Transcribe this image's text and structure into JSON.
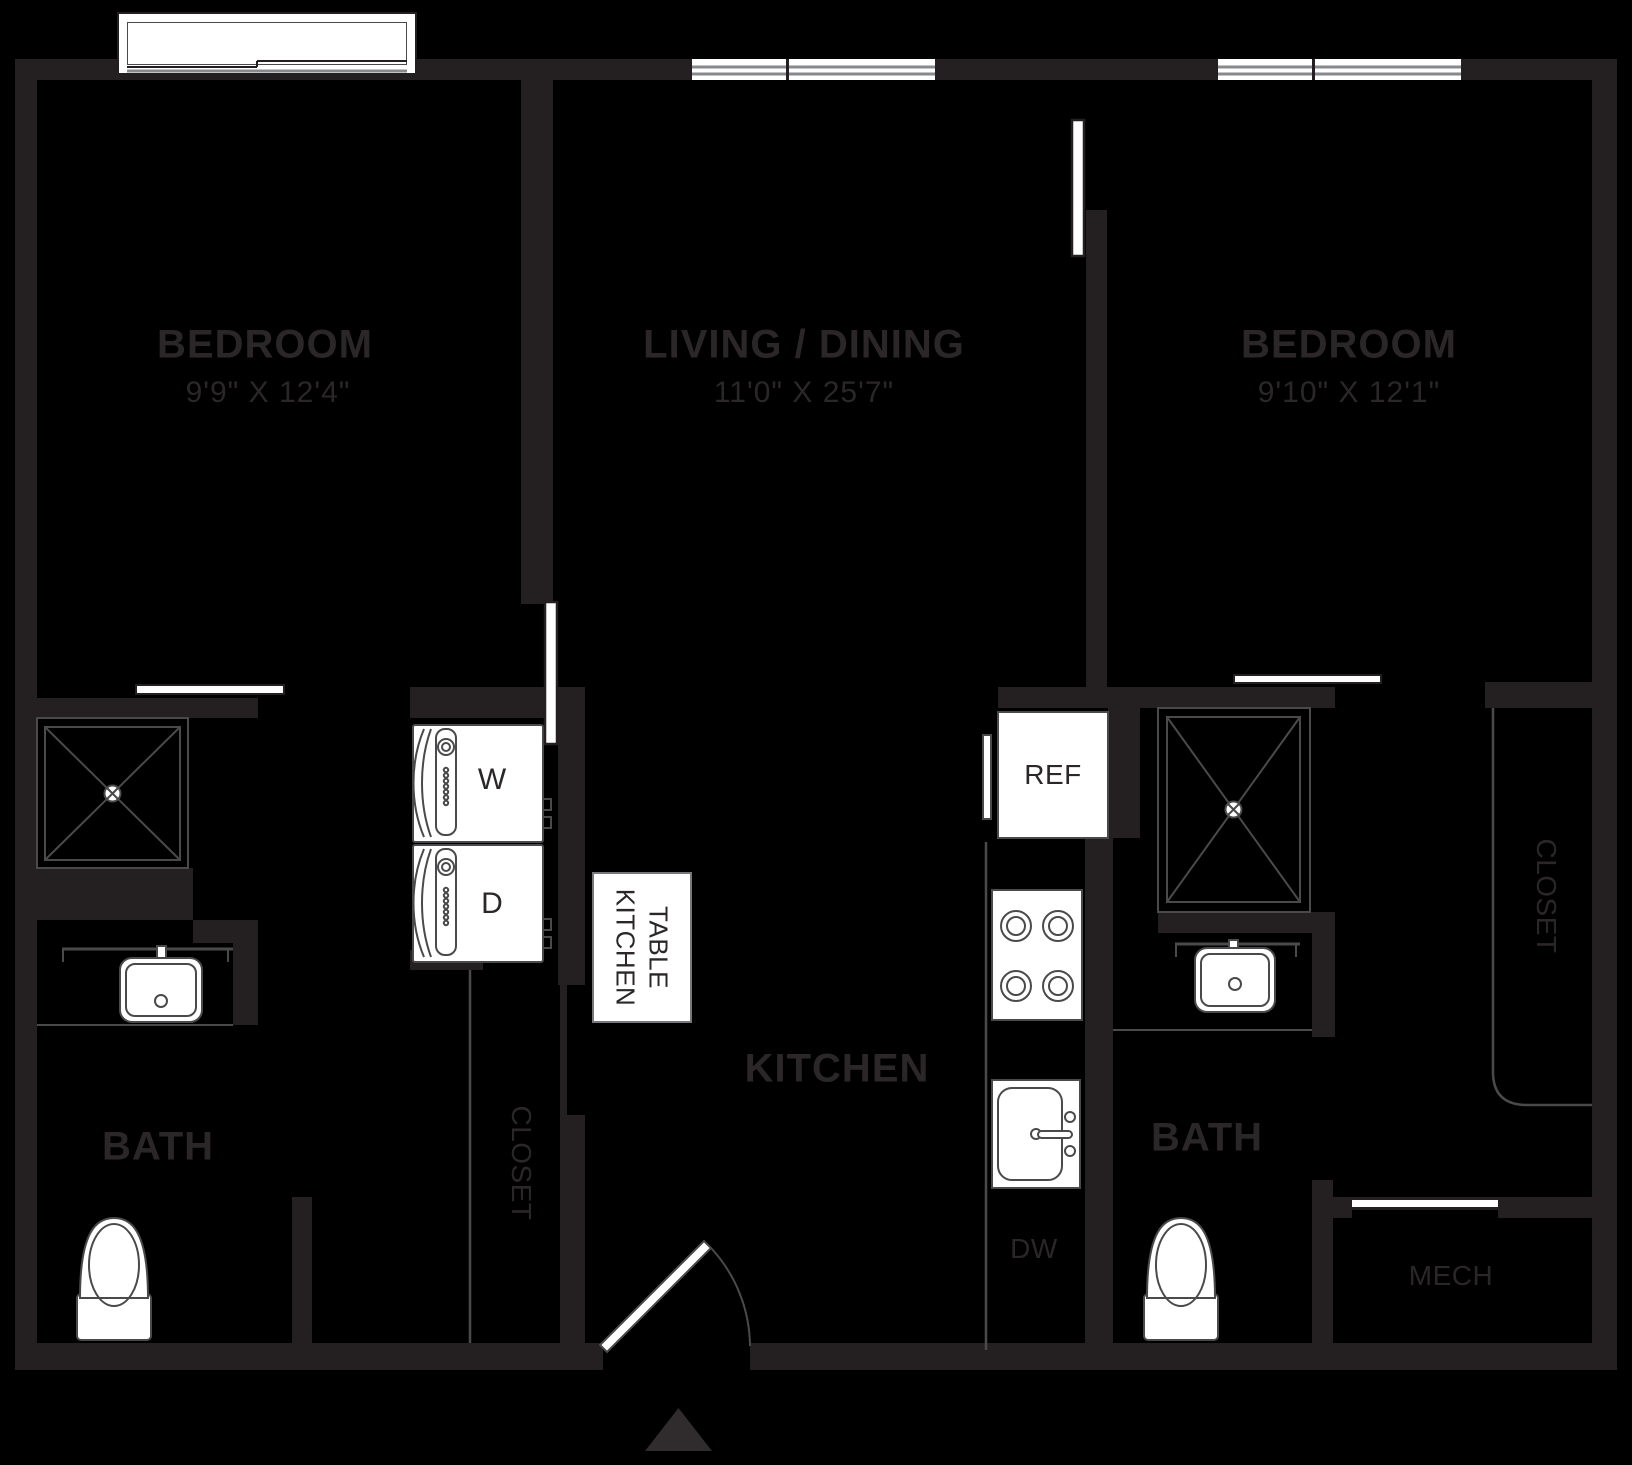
{
  "colors": {
    "background": "#000000",
    "wall": "#241f20",
    "fixture_line": "#4a4a4c",
    "window_line": "#87898c",
    "text": "#2b2728",
    "entry_triangle": "#302c2d"
  },
  "rooms": {
    "bedroom_left": {
      "title": "BEDROOM",
      "dims": "9'9\" X 12'4\""
    },
    "living_dining": {
      "title": "LIVING / DINING",
      "dims": "11'0\" X 25'7\""
    },
    "bedroom_right": {
      "title": "BEDROOM",
      "dims": "9'10\" X 12'1\""
    },
    "kitchen": {
      "title": "KITCHEN"
    },
    "bath_left": {
      "title": "BATH"
    },
    "bath_right": {
      "title": "BATH"
    },
    "mech": {
      "title": "MECH"
    },
    "closet_left": {
      "title": "CLOSET"
    },
    "closet_right": {
      "title": "CLOSET"
    }
  },
  "fixtures": {
    "refrigerator": "REF",
    "dishwasher": "DW",
    "washer": "W",
    "dryer": "D",
    "kitchen_table": {
      "line1": "KITCHEN",
      "line2": "TABLE"
    }
  }
}
